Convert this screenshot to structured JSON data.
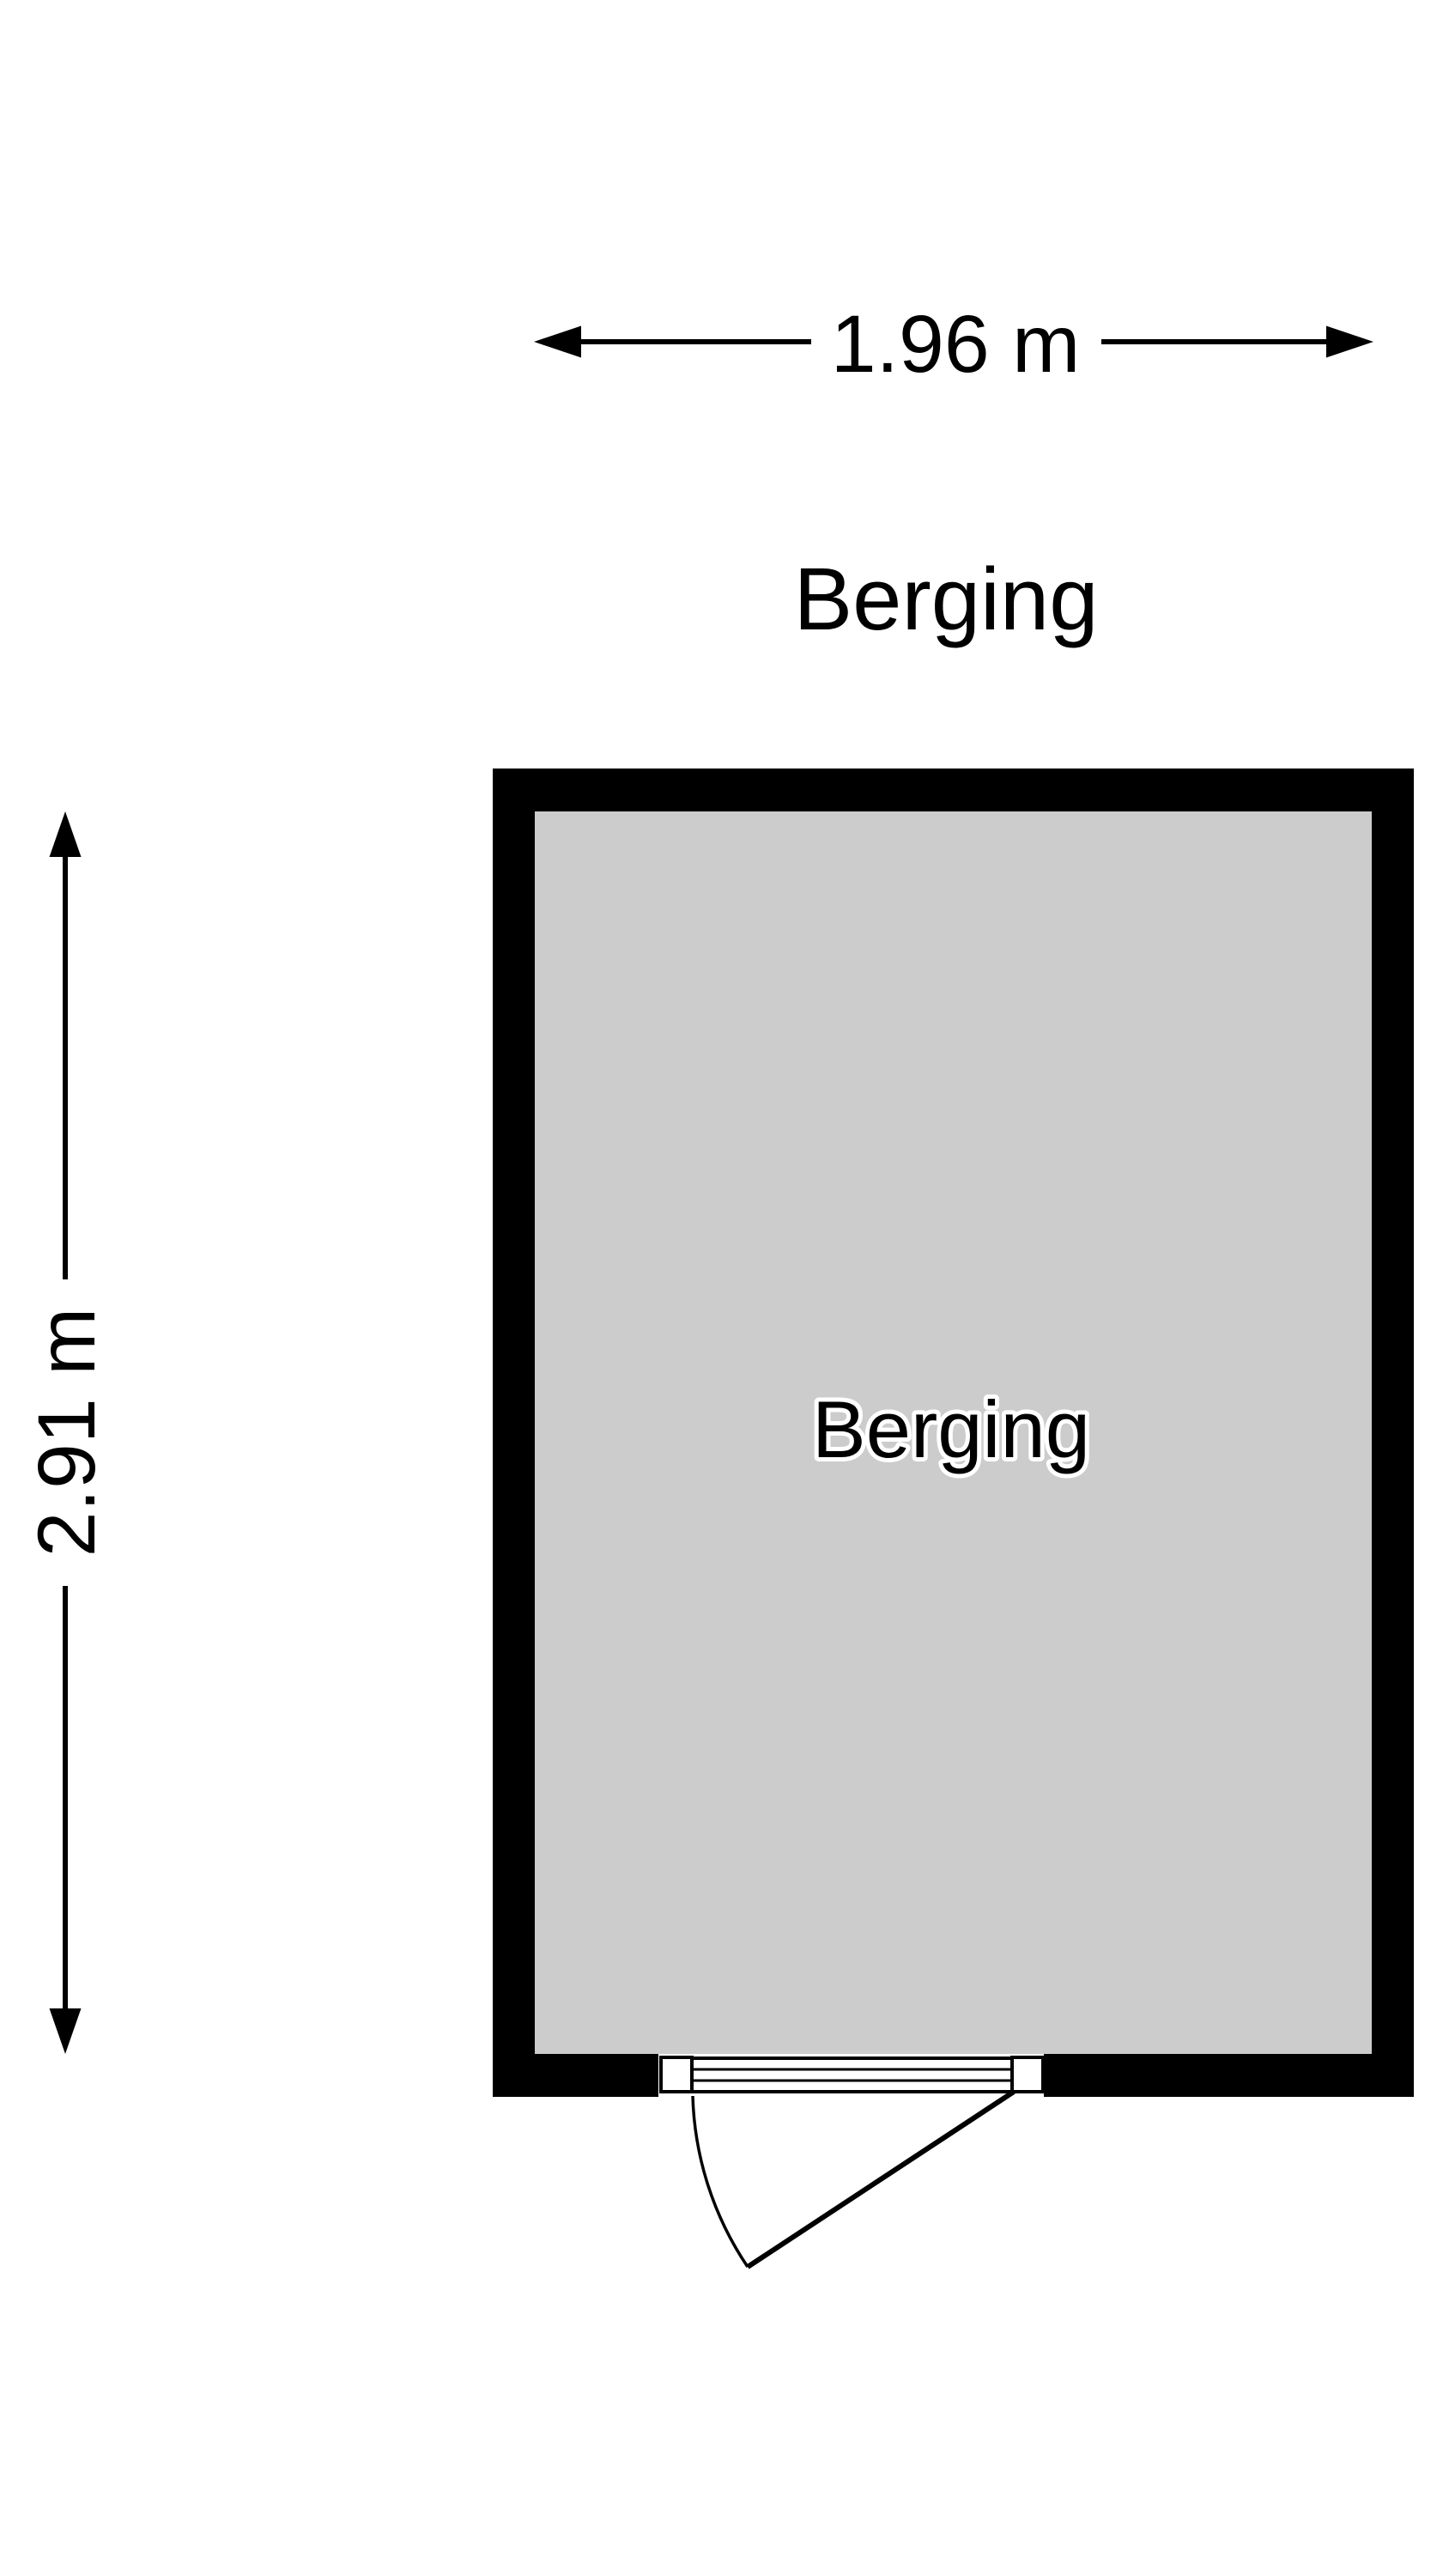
{
  "page": {
    "background": "#ffffff"
  },
  "title": {
    "text": "Berging"
  },
  "room": {
    "label": "Berging",
    "wall_color": "#000000",
    "floor_color": "#cccccc"
  },
  "dimensions": {
    "width": {
      "label": "1.96 m"
    },
    "height": {
      "label": "2.91 m"
    }
  }
}
